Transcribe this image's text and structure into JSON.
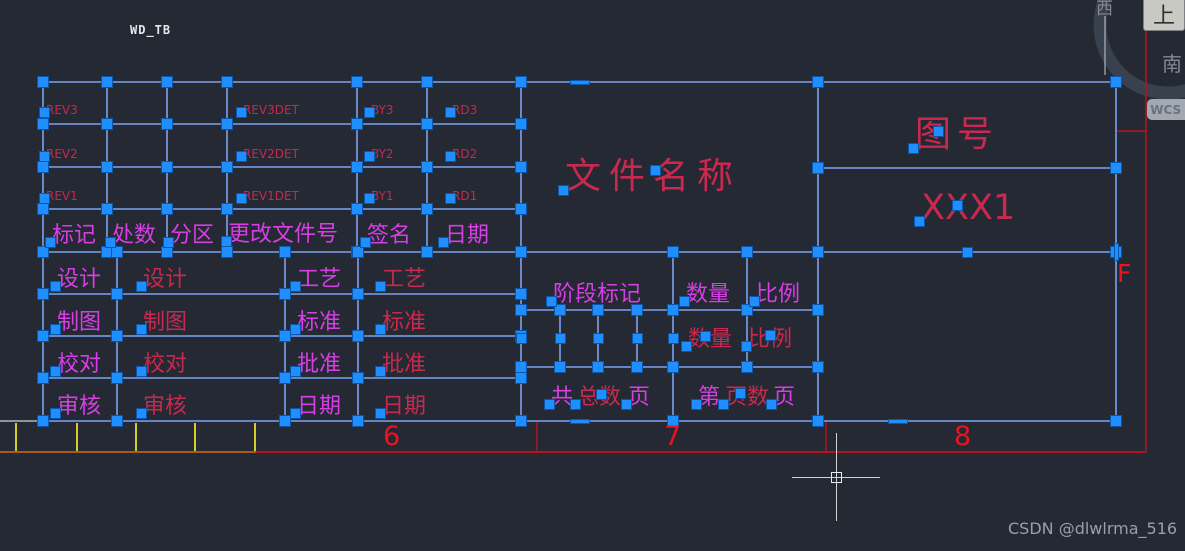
{
  "app": {
    "origin_marker": "WD_TB",
    "watermark": "CSDN @dlwlrma_516"
  },
  "viewcube": {
    "top_label": "上",
    "west_label": "西",
    "south_label": "南",
    "wcs_label": "WCS",
    "caret": "▾"
  },
  "colors": {
    "background": "#242933",
    "grid": "#7da2f0",
    "grip": "#1f8fff",
    "magenta": "#d93ee6",
    "crimson": "#c9294e",
    "red": "#b5121f",
    "num": "#ee1122",
    "orange": "#a85a20",
    "yellow": "#d2cd28",
    "grey": "#8f959d",
    "white": "#c8ccd2",
    "chrome_text": "#e6e8ea",
    "watermark": "#98a0ac",
    "cube_face": "#c9c9c4",
    "cube_text": "#2e3033",
    "compass_text": "#828894",
    "ring": "#39404e",
    "wcs_bg": "#a3a9b0",
    "wcs_text": "#6b727b"
  },
  "frame": {
    "row_label": "F",
    "zone_numbers": [
      {
        "t": "6",
        "x": 383
      },
      {
        "t": "7",
        "x": 664
      },
      {
        "t": "8",
        "x": 954
      }
    ],
    "zone_number_y": 423
  },
  "drawing": {
    "h_lines": [
      [
        82,
        43,
        1116
      ],
      [
        124,
        43,
        521
      ],
      [
        167,
        43,
        521
      ],
      [
        209,
        43,
        521
      ],
      [
        252,
        43,
        1116
      ],
      [
        294,
        43,
        521
      ],
      [
        336,
        43,
        521
      ],
      [
        378,
        43,
        521
      ],
      [
        421,
        43,
        1116
      ],
      [
        310,
        521,
        818
      ],
      [
        367,
        521,
        818
      ],
      [
        168,
        818,
        1116
      ]
    ],
    "v_lines": [
      [
        43,
        82,
        421
      ],
      [
        107,
        82,
        252
      ],
      [
        167,
        82,
        252
      ],
      [
        227,
        82,
        252
      ],
      [
        357,
        82,
        252
      ],
      [
        427,
        82,
        252
      ],
      [
        117,
        252,
        421
      ],
      [
        285,
        252,
        421
      ],
      [
        358,
        252,
        421
      ],
      [
        521,
        82,
        421
      ],
      [
        560,
        310,
        367
      ],
      [
        598,
        310,
        367
      ],
      [
        637,
        310,
        367
      ],
      [
        673,
        252,
        421
      ],
      [
        747,
        252,
        367
      ],
      [
        818,
        82,
        421
      ],
      [
        1116,
        82,
        421
      ]
    ],
    "decor_lines": [
      [
        0,
        421,
        40,
        421,
        "grey",
        2,
        "paper-edge-line"
      ],
      [
        1105,
        16,
        1105,
        75,
        "white",
        1,
        "viewcube-compass-line"
      ],
      [
        16,
        423,
        16,
        451,
        "yellow",
        2,
        "frame-tick"
      ],
      [
        77,
        423,
        77,
        451,
        "yellow",
        2,
        "frame-tick"
      ],
      [
        136,
        423,
        136,
        451,
        "yellow",
        2,
        "frame-tick"
      ],
      [
        195,
        423,
        195,
        451,
        "yellow",
        2,
        "frame-tick"
      ],
      [
        255,
        423,
        255,
        451,
        "yellow",
        2,
        "frame-tick"
      ],
      [
        0,
        452,
        1146,
        452,
        "red",
        2,
        "frame-bottom-line"
      ],
      [
        0,
        452,
        256,
        452,
        "orange",
        2,
        "frame-bottom-line-left"
      ],
      [
        537,
        422,
        537,
        452,
        "red",
        1.5,
        "zone-divider-tick"
      ],
      [
        826,
        422,
        826,
        452,
        "red",
        1.5,
        "zone-divider-tick"
      ],
      [
        1146,
        0,
        1146,
        452,
        "red",
        1.5,
        "frame-right-line"
      ],
      [
        1117,
        131,
        1146,
        131,
        "red",
        1.5,
        "row-divider-tick"
      ]
    ],
    "texts": [
      {
        "t": "REV3",
        "x": 46,
        "y": 104,
        "fs": 12,
        "c": "crimson"
      },
      {
        "t": "REV3DET",
        "x": 243,
        "y": 104,
        "fs": 12,
        "c": "crimson"
      },
      {
        "t": "BY3",
        "x": 371,
        "y": 104,
        "fs": 12,
        "c": "crimson"
      },
      {
        "t": "RD3",
        "x": 452,
        "y": 104,
        "fs": 12,
        "c": "crimson"
      },
      {
        "t": "REV2",
        "x": 46,
        "y": 148,
        "fs": 12,
        "c": "crimson"
      },
      {
        "t": "REV2DET",
        "x": 243,
        "y": 148,
        "fs": 12,
        "c": "crimson"
      },
      {
        "t": "BY2",
        "x": 371,
        "y": 148,
        "fs": 12,
        "c": "crimson"
      },
      {
        "t": "RD2",
        "x": 452,
        "y": 148,
        "fs": 12,
        "c": "crimson"
      },
      {
        "t": "REV1",
        "x": 46,
        "y": 190,
        "fs": 12,
        "c": "crimson"
      },
      {
        "t": "REV1DET",
        "x": 243,
        "y": 190,
        "fs": 12,
        "c": "crimson"
      },
      {
        "t": "BY1",
        "x": 371,
        "y": 190,
        "fs": 12,
        "c": "crimson"
      },
      {
        "t": "RD1",
        "x": 452,
        "y": 190,
        "fs": 12,
        "c": "crimson"
      },
      {
        "t": "标记",
        "x": 52,
        "y": 224,
        "fs": 22,
        "c": "magenta"
      },
      {
        "t": "处数",
        "x": 112,
        "y": 224,
        "fs": 22,
        "c": "magenta"
      },
      {
        "t": "分区",
        "x": 170,
        "y": 224,
        "fs": 22,
        "c": "magenta"
      },
      {
        "t": "更改文件号",
        "x": 228,
        "y": 223,
        "fs": 22,
        "c": "magenta"
      },
      {
        "t": "签名",
        "x": 367,
        "y": 224,
        "fs": 22,
        "c": "magenta"
      },
      {
        "t": "日期",
        "x": 445,
        "y": 224,
        "fs": 22,
        "c": "magenta"
      },
      {
        "t": "设计",
        "x": 57,
        "y": 268,
        "fs": 22,
        "c": "magenta"
      },
      {
        "t": "设计",
        "x": 143,
        "y": 268,
        "fs": 22,
        "c": "crimson"
      },
      {
        "t": "工艺",
        "x": 297,
        "y": 268,
        "fs": 22,
        "c": "magenta"
      },
      {
        "t": "工艺",
        "x": 382,
        "y": 268,
        "fs": 22,
        "c": "crimson"
      },
      {
        "t": "制图",
        "x": 57,
        "y": 311,
        "fs": 22,
        "c": "magenta"
      },
      {
        "t": "制图",
        "x": 143,
        "y": 311,
        "fs": 22,
        "c": "crimson"
      },
      {
        "t": "标准",
        "x": 297,
        "y": 311,
        "fs": 22,
        "c": "magenta"
      },
      {
        "t": "标准",
        "x": 382,
        "y": 311,
        "fs": 22,
        "c": "crimson"
      },
      {
        "t": "校对",
        "x": 57,
        "y": 353,
        "fs": 22,
        "c": "magenta"
      },
      {
        "t": "校对",
        "x": 143,
        "y": 353,
        "fs": 22,
        "c": "crimson"
      },
      {
        "t": "批准",
        "x": 297,
        "y": 353,
        "fs": 22,
        "c": "magenta"
      },
      {
        "t": "批准",
        "x": 382,
        "y": 353,
        "fs": 22,
        "c": "crimson"
      },
      {
        "t": "审核",
        "x": 57,
        "y": 395,
        "fs": 22,
        "c": "magenta"
      },
      {
        "t": "审核",
        "x": 143,
        "y": 395,
        "fs": 22,
        "c": "crimson"
      },
      {
        "t": "日期",
        "x": 297,
        "y": 395,
        "fs": 22,
        "c": "magenta"
      },
      {
        "t": "日期",
        "x": 382,
        "y": 395,
        "fs": 22,
        "c": "crimson"
      },
      {
        "t": "阶段标记",
        "x": 553,
        "y": 283,
        "fs": 22,
        "c": "magenta"
      },
      {
        "t": "数量",
        "x": 686,
        "y": 283,
        "fs": 22,
        "c": "magenta"
      },
      {
        "t": "比例",
        "x": 756,
        "y": 283,
        "fs": 22,
        "c": "magenta"
      },
      {
        "t": "数量",
        "x": 688,
        "y": 328,
        "fs": 22,
        "c": "crimson"
      },
      {
        "t": "比例",
        "x": 748,
        "y": 328,
        "fs": 22,
        "c": "crimson"
      },
      {
        "t": "共",
        "x": 551,
        "y": 386,
        "fs": 22,
        "c": "magenta"
      },
      {
        "t": "总数",
        "x": 577,
        "y": 386,
        "fs": 22,
        "c": "crimson"
      },
      {
        "t": "页",
        "x": 628,
        "y": 386,
        "fs": 22,
        "c": "magenta"
      },
      {
        "t": "第",
        "x": 698,
        "y": 386,
        "fs": 22,
        "c": "magenta"
      },
      {
        "t": "页数",
        "x": 725,
        "y": 386,
        "fs": 22,
        "c": "crimson"
      },
      {
        "t": "页",
        "x": 773,
        "y": 386,
        "fs": 22,
        "c": "magenta"
      },
      {
        "t": "文件名称",
        "x": 565,
        "y": 158,
        "fs": 36,
        "ls": 8,
        "c": "crimson"
      },
      {
        "t": "图号",
        "x": 915,
        "y": 116,
        "fs": 36,
        "ls": 6,
        "c": "crimson"
      },
      {
        "t": "XXX1",
        "x": 921,
        "y": 190,
        "fs": 35,
        "ls": 0,
        "c": "crimson"
      }
    ],
    "extra_grips": [
      [
        560,
        338
      ],
      [
        598,
        338
      ],
      [
        637,
        338
      ],
      [
        673,
        338
      ],
      [
        521,
        338
      ],
      [
        655,
        170
      ],
      [
        938,
        131
      ],
      [
        957,
        205
      ],
      [
        705,
        336
      ],
      [
        770,
        335
      ],
      [
        601,
        394
      ],
      [
        740,
        393
      ],
      [
        967,
        252
      ]
    ],
    "dash_grips": [
      {
        "x": 580,
        "y": 82,
        "w": 20,
        "h": 5
      },
      {
        "x": 580,
        "y": 421,
        "w": 20,
        "h": 5
      },
      {
        "x": 898,
        "y": 421,
        "w": 20,
        "h": 5
      },
      {
        "x": 1116,
        "y": 252,
        "w": 5,
        "h": 18
      }
    ],
    "viewcube_ring": {
      "cx": 1168,
      "cy": 25,
      "r": 68,
      "w": 13
    },
    "crosshair": {
      "cx": 836,
      "cy": 477,
      "arm": 44,
      "box": 11
    }
  }
}
